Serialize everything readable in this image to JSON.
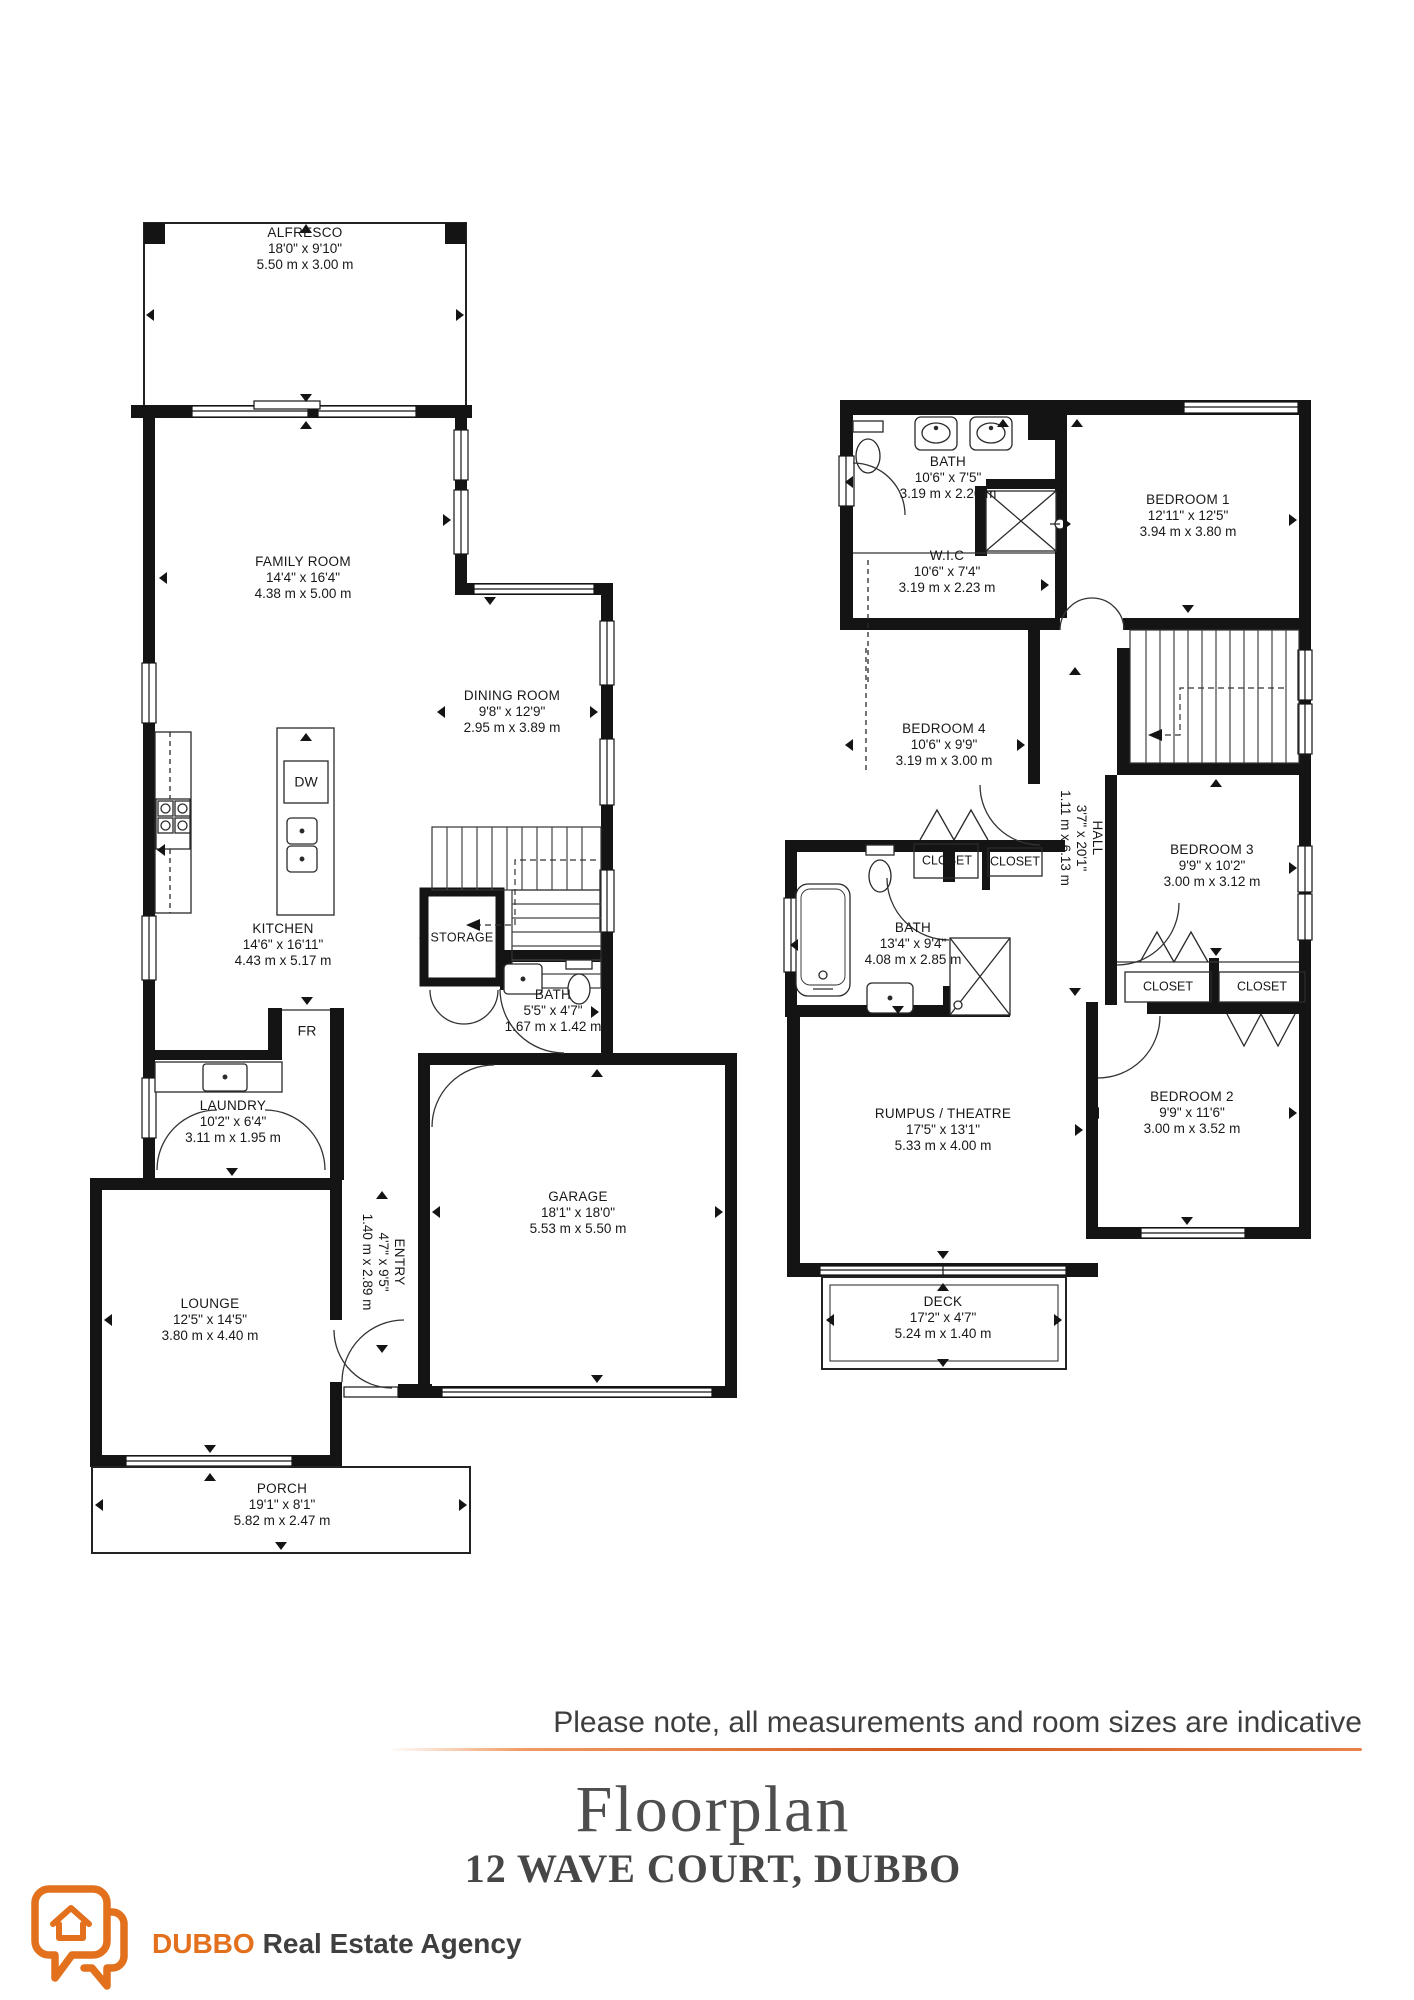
{
  "rooms": {
    "alfresco": {
      "name": "ALFRESCO",
      "imperial": "18'0\" x 9'10\"",
      "metric": "5.50 m x 3.00 m"
    },
    "family": {
      "name": "FAMILY ROOM",
      "imperial": "14'4\" x 16'4\"",
      "metric": "4.38 m x 5.00 m"
    },
    "dining": {
      "name": "DINING ROOM",
      "imperial": "9'8\" x 12'9\"",
      "metric": "2.95 m x 3.89 m"
    },
    "kitchen": {
      "name": "KITCHEN",
      "imperial": "14'6\" x 16'11\"",
      "metric": "4.43 m x 5.17 m"
    },
    "storage": {
      "name": "STORAGE"
    },
    "bath_ground": {
      "name": "BATH",
      "imperial": "5'5\" x 4'7\"",
      "metric": "1.67 m x 1.42 m"
    },
    "laundry": {
      "name": "LAUNDRY",
      "imperial": "10'2\" x 6'4\"",
      "metric": "3.11 m x 1.95 m"
    },
    "entry": {
      "name": "ENTRY",
      "imperial": "4'7\" x 9'5\"",
      "metric": "1.40 m x 2.89 m"
    },
    "lounge": {
      "name": "LOUNGE",
      "imperial": "12'5\" x 14'5\"",
      "metric": "3.80 m x 4.40 m"
    },
    "garage": {
      "name": "GARAGE",
      "imperial": "18'1\" x 18'0\"",
      "metric": "5.53 m x 5.50 m"
    },
    "porch": {
      "name": "PORCH",
      "imperial": "19'1\" x 8'1\"",
      "metric": "5.82 m x 2.47 m"
    },
    "bath_upper": {
      "name": "BATH",
      "imperial": "10'6\" x 7'5\"",
      "metric": "3.19 m x 2.26 m"
    },
    "wic": {
      "name": "W.I.C",
      "imperial": "10'6\" x 7'4\"",
      "metric": "3.19 m x 2.23 m"
    },
    "bedroom1": {
      "name": "BEDROOM 1",
      "imperial": "12'11\" x 12'5\"",
      "metric": "3.94 m x 3.80 m"
    },
    "bedroom4": {
      "name": "BEDROOM 4",
      "imperial": "10'6\" x 9'9\"",
      "metric": "3.19 m x 3.00 m"
    },
    "hall": {
      "name": "HALL",
      "imperial": "3'7\" x 20'1\"",
      "metric": "1.11 m x 6.13 m"
    },
    "bath_mid": {
      "name": "BATH",
      "imperial": "13'4\" x 9'4\"",
      "metric": "4.08 m x 2.85 m"
    },
    "bedroom3": {
      "name": "BEDROOM 3",
      "imperial": "9'9\" x 10'2\"",
      "metric": "3.00 m x 3.12 m"
    },
    "bedroom2": {
      "name": "BEDROOM 2",
      "imperial": "9'9\" x 11'6\"",
      "metric": "3.00 m x 3.52 m"
    },
    "rumpus": {
      "name": "RUMPUS / THEATRE",
      "imperial": "17'5\" x 13'1\"",
      "metric": "5.33 m x 4.00 m"
    },
    "deck": {
      "name": "DECK",
      "imperial": "17'2\" x 4'7\"",
      "metric": "5.24 m x 1.40 m"
    },
    "closet": {
      "name": "CLOSET"
    }
  },
  "appliances": {
    "dishwasher": "DW",
    "fridge": "FR"
  },
  "footer": {
    "disclaimer": "Please note, all measurements and room sizes are indicative",
    "title": "Floorplan",
    "address": "12 WAVE COURT, DUBBO"
  },
  "logo": {
    "brand": "DUBBO",
    "suffix": "Real Estate Agency"
  },
  "colors": {
    "accent": "#E2701C",
    "wall": "#141414",
    "text": "#3E3E3E"
  }
}
